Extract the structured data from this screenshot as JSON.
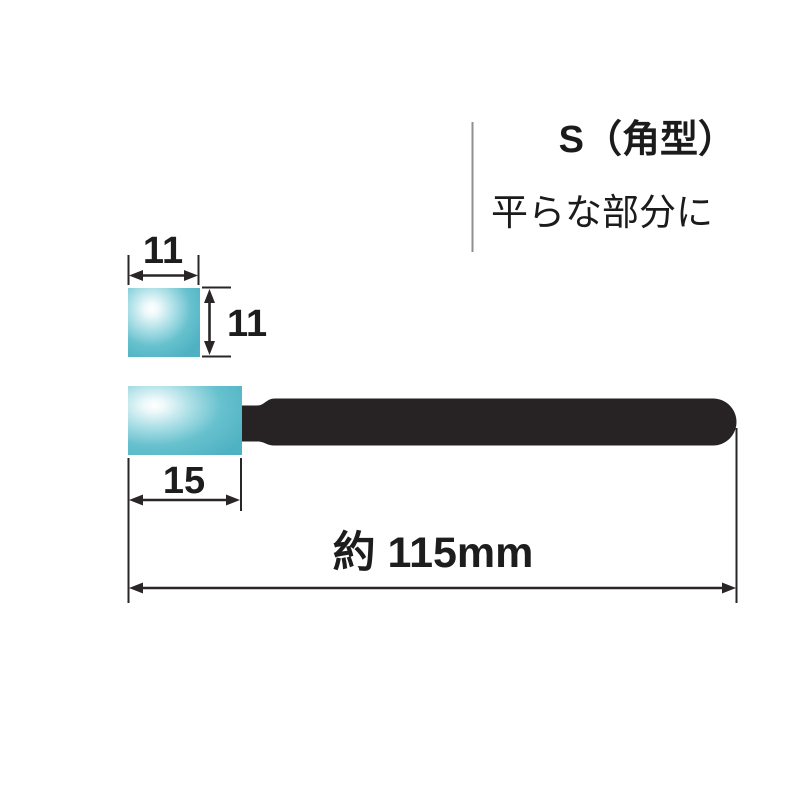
{
  "header": {
    "title": "S（角型）",
    "subtitle": "平らな部分に"
  },
  "dimensions": {
    "tip_width": "11",
    "tip_height": "11",
    "tip_length": "15",
    "total_length": "約 115mm"
  },
  "colors": {
    "tip_teal": "#52b5c5",
    "tip_highlight": "#ffffff",
    "handle_black": "#272223",
    "dimension_line": "#2a2627",
    "divider_gray": "#8f8f8f",
    "text": "#1b1b1b",
    "background": "#ffffff"
  }
}
